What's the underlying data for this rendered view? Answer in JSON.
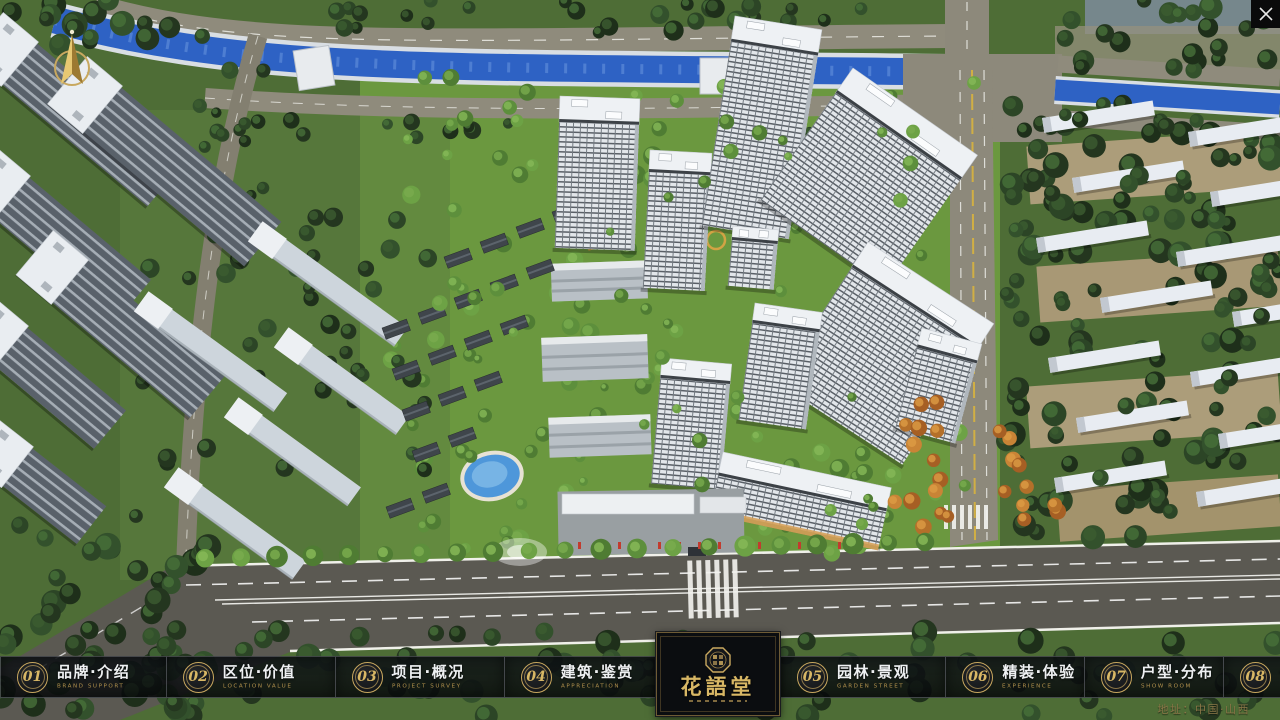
{
  "nav": {
    "items": [
      {
        "num": "01",
        "zh": "品牌·介绍",
        "en": "BRAND SUPPORT"
      },
      {
        "num": "02",
        "zh": "区位·价值",
        "en": "LOCATION VALUE"
      },
      {
        "num": "03",
        "zh": "项目·概况",
        "en": "PROJECT SURVEY"
      },
      {
        "num": "04",
        "zh": "建筑·鉴赏",
        "en": "APPRECIATION"
      },
      {
        "num": "05",
        "zh": "园林·景观",
        "en": "GARDEN STREET"
      },
      {
        "num": "06",
        "zh": "精装·体验",
        "en": "EXPERIENCE"
      },
      {
        "num": "07",
        "zh": "户型·分布",
        "en": "SHOW ROOM"
      },
      {
        "num": "08",
        "zh": "一房·一景",
        "en": "COMMUNITY"
      }
    ]
  },
  "logo": {
    "title": "花語堂"
  },
  "footer": {
    "address": "地址：中国·山西"
  },
  "colors": {
    "gold": "#c9a85f",
    "nav_bg": "rgba(10,13,16,0.82)",
    "river": "#2e62c4",
    "lawn": "#729f42"
  }
}
